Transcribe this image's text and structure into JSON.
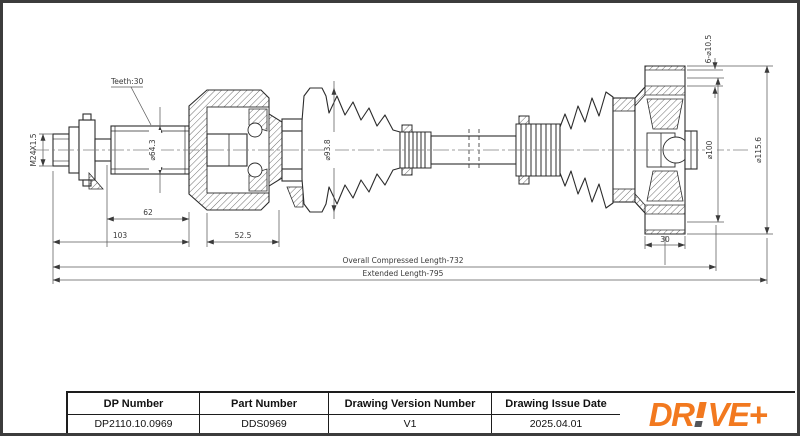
{
  "drawing": {
    "teeth": "Teeth:30",
    "thread": "M24X1.5",
    "spline_diameter": "⌀64.3",
    "len_62": "62",
    "len_103": "103",
    "len_52_5": "52.5",
    "boot_diameter": "⌀93.8",
    "bolt_holes": "6-⌀10.5",
    "bolt_circle": "⌀100",
    "flange_diameter": "⌀115.6",
    "flange_width": "30",
    "compressed_length": "Overall Compressed Length-732",
    "extended_length": "Extended Length-795"
  },
  "title_block": {
    "dp": {
      "header": "DP Number",
      "value": "DP2110.10.0969"
    },
    "part": {
      "header": "Part Number",
      "value": "DDS0969"
    },
    "version": {
      "header": "Drawing Version Number",
      "value": "V1"
    },
    "date": {
      "header": "Drawing Issue Date",
      "value": "2025.04.01"
    }
  },
  "logo": {
    "full": "DR!VE+",
    "prefix": "DR",
    "suffix": "VE+"
  },
  "colors": {
    "logo_orange": "#F2791F",
    "logo_gray": "#54565A",
    "line_dark": "#2c2c2c"
  }
}
